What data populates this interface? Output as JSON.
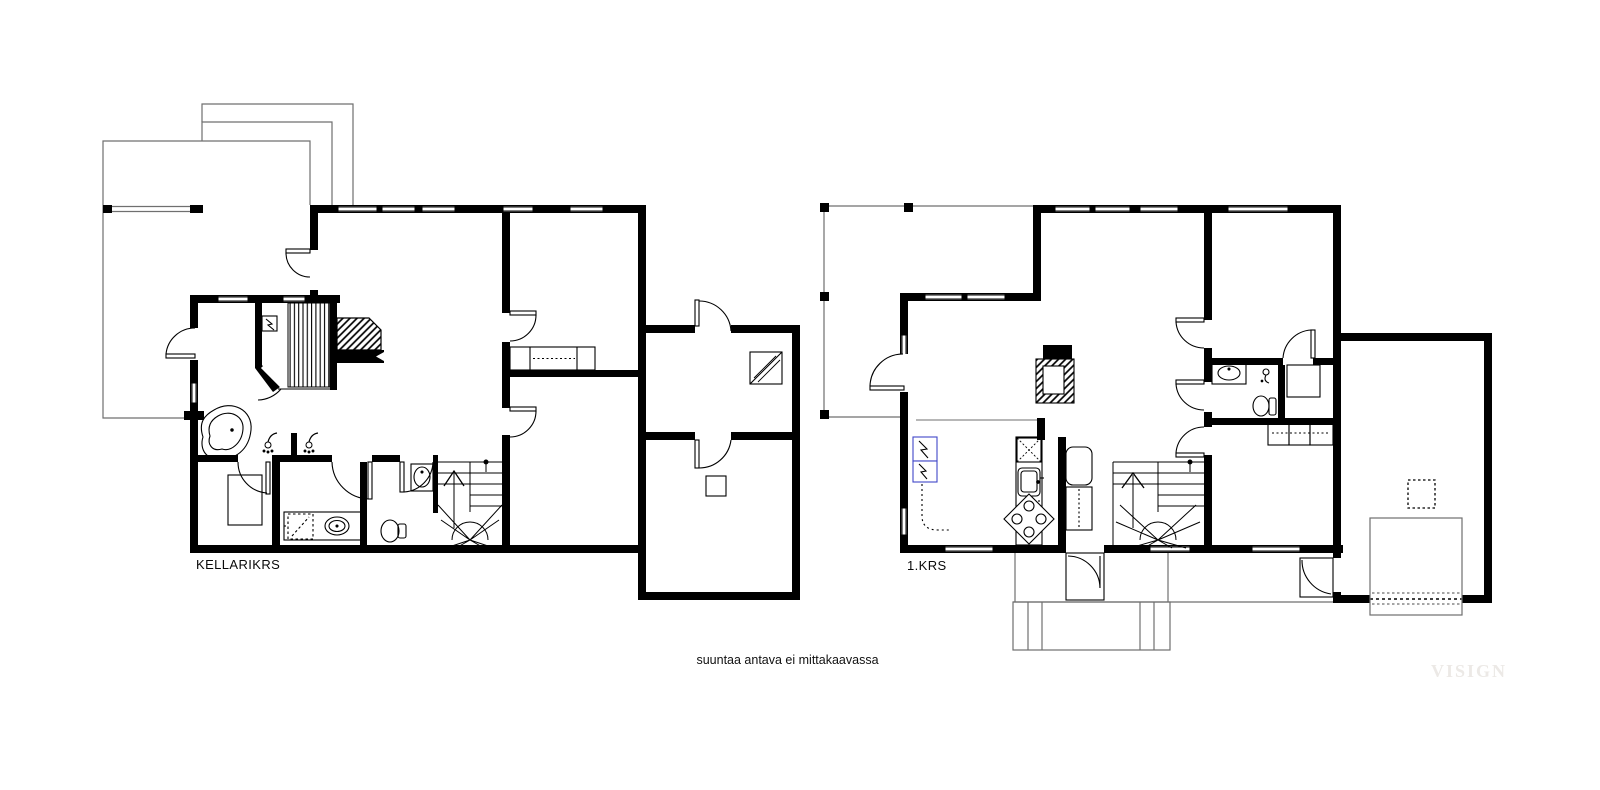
{
  "floors": [
    {
      "id": "kellarikrs",
      "label": "KELLARIKRS"
    },
    {
      "id": "1krs",
      "label": "1.KRS"
    }
  ],
  "caption": "suuntaa antava ei mittakaavassa",
  "watermark": "VISIGN",
  "colors": {
    "wall": "#000000",
    "thin_line": "#1c1c1c",
    "terrace_line": "#6f6f6f",
    "appliance_accent": "#4046c8",
    "watermark": "#ece9e6",
    "background": "#ffffff"
  }
}
